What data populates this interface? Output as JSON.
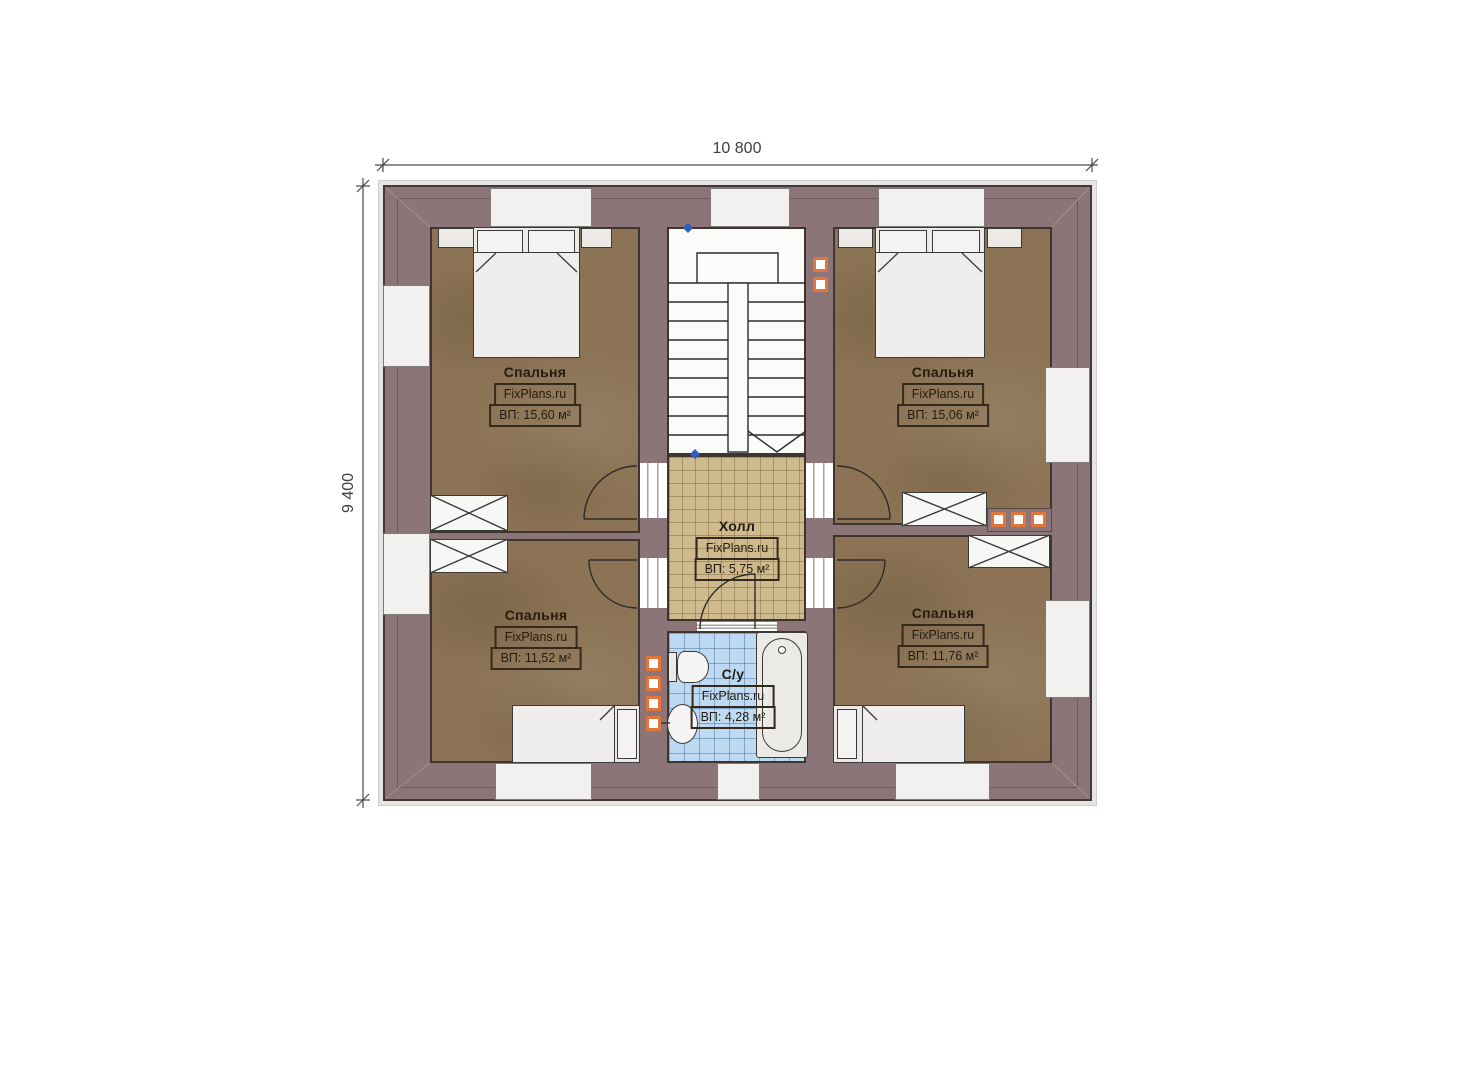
{
  "plan": {
    "width_dim": "10 800",
    "height_dim": "9 400",
    "rooms": [
      {
        "name": "Спальня",
        "brand": "FixPlans.ru",
        "area": "ВП: 15,60 м²"
      },
      {
        "name": "Спальня",
        "brand": "FixPlans.ru",
        "area": "ВП: 15,06 м²"
      },
      {
        "name": "Спальня",
        "brand": "FixPlans.ru",
        "area": "ВП: 11,52 м²"
      },
      {
        "name": "Спальня",
        "brand": "FixPlans.ru",
        "area": "ВП: 11,76 м²"
      },
      {
        "name": "Холл",
        "brand": "FixPlans.ru",
        "area": "ВП: 5,75 м²"
      },
      {
        "name": "С/у",
        "brand": "FixPlans.ru",
        "area": "ВП: 4,28 м²"
      }
    ],
    "colors": {
      "wall": "#8b7578",
      "bedroom_floor": "#8c7355",
      "hall_floor": "#cfba8e",
      "bath_floor": "#bedaf3",
      "furniture": "#eceae6",
      "accent_orange": "#e0763c",
      "dimension_text": "#3f3f3f"
    }
  }
}
